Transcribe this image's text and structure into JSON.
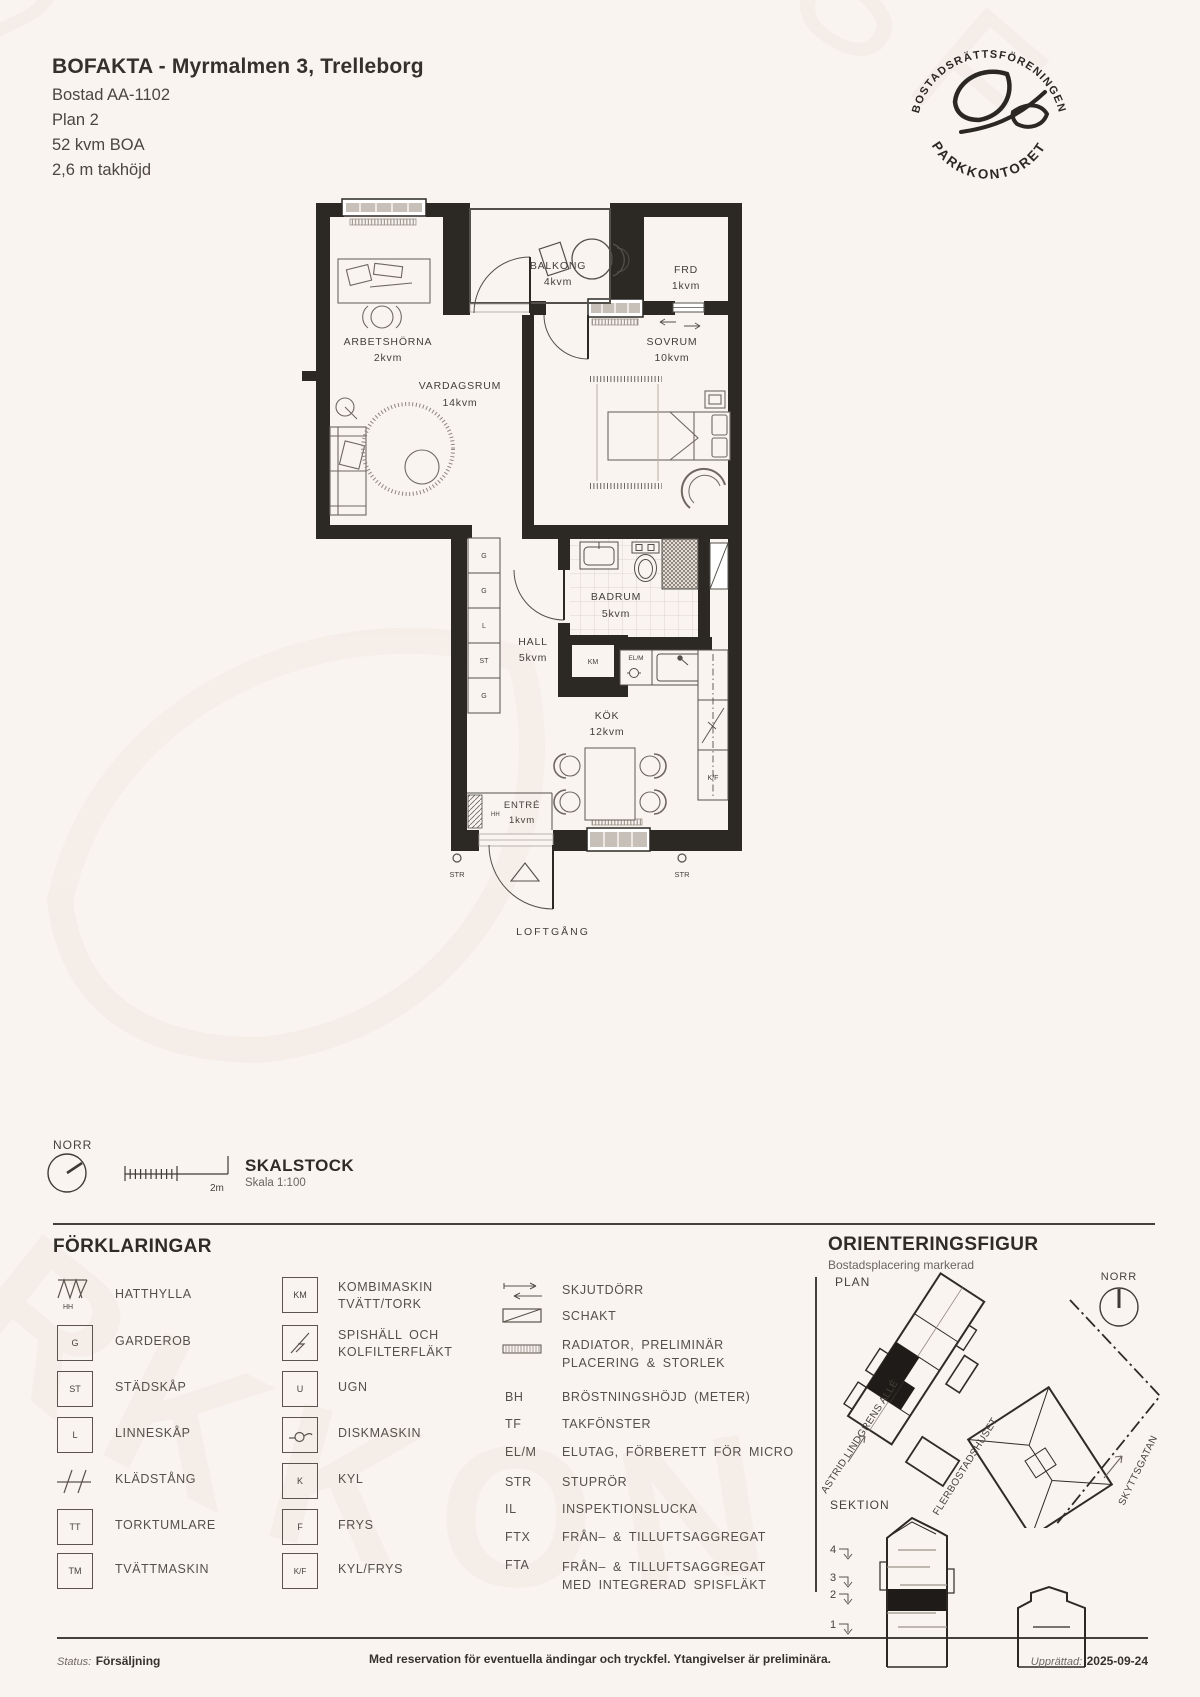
{
  "header": {
    "title": "BOFAKTA - Myrmalmen 3, Trelleborg",
    "lines": [
      "Bostad AA-1102",
      "Plan 2",
      "52 kvm BOA",
      "2,6 m takhöjd"
    ]
  },
  "logo": {
    "top": "BOSTADSRÄTTSFÖRENINGEN",
    "bottom": "• PARKKONTORET •"
  },
  "plan": {
    "rooms": {
      "arbetshorna": {
        "name": "ARBETSHÖRNA",
        "area": "2kvm"
      },
      "balkong": {
        "name": "BALKONG",
        "area": "4kvm"
      },
      "frd": {
        "name": "FRD",
        "area": "1kvm"
      },
      "sovrum": {
        "name": "SOVRUM",
        "area": "10kvm"
      },
      "vardagsrum": {
        "name": "VARDAGSRUM",
        "area": "14kvm"
      },
      "badrum": {
        "name": "BADRUM",
        "area": "5kvm"
      },
      "hall": {
        "name": "HALL",
        "area": "5kvm"
      },
      "kok": {
        "name": "KÖK",
        "area": "12kvm"
      },
      "entre": {
        "name": "ENTRÉ",
        "area": "1kvm"
      }
    },
    "marks": {
      "g": "G",
      "st": "ST",
      "l": "L",
      "km": "KM",
      "elm": "EL/M",
      "kf": "K/F",
      "hh": "HH",
      "str": "STR"
    },
    "loftgang": "LOFTGÅNG"
  },
  "compass": {
    "label": "NORR"
  },
  "scale": {
    "title": "SKALSTOCK",
    "subtitle": "Skala 1:100",
    "bar_label": "2m"
  },
  "legend": {
    "title": "FÖRKLARINGAR",
    "col1": [
      {
        "sym": "HH",
        "label": "HATTHYLLA"
      },
      {
        "sym": "G",
        "label": "GARDEROB"
      },
      {
        "sym": "ST",
        "label": "STÄDSKÅP"
      },
      {
        "sym": "L",
        "label": "LINNESKÅP"
      },
      {
        "sym": "",
        "label": "KLÄDSTÅNG"
      },
      {
        "sym": "TT",
        "label": "TORKTUMLARE"
      },
      {
        "sym": "TM",
        "label": "TVÄTTMASKIN"
      }
    ],
    "col2": [
      {
        "sym": "KM",
        "label": "KOMBIMASKIN",
        "label2": "TVÄTT/TORK"
      },
      {
        "sym": "",
        "label": "SPISHÄLL OCH",
        "label2": "KOLFILTERFLÄKT"
      },
      {
        "sym": "U",
        "label": "UGN"
      },
      {
        "sym": "",
        "label": "DISKMASKIN"
      },
      {
        "sym": "K",
        "label": "KYL"
      },
      {
        "sym": "F",
        "label": "FRYS"
      },
      {
        "sym": "K/F",
        "label": "KYL/FRYS"
      }
    ],
    "col3": [
      {
        "abbr": "",
        "label": "SKJUTDÖRR"
      },
      {
        "abbr": "",
        "label": "SCHAKT"
      },
      {
        "abbr": "",
        "label": "RADIATOR, PRELIMINÄR",
        "label2": "PLACERING & STORLEK"
      },
      {
        "abbr": "BH",
        "label": "BRÖSTNINGSHÖJD (METER)"
      },
      {
        "abbr": "TF",
        "label": "TAKFÖNSTER"
      },
      {
        "abbr": "EL/M",
        "label": "ELUTAG, FÖRBERETT FÖR MICRO"
      },
      {
        "abbr": "STR",
        "label": "STUPRÖR"
      },
      {
        "abbr": "IL",
        "label": "INSPEKTIONSLUCKA"
      },
      {
        "abbr": "FTX",
        "label": "FRÅN– & TILLUFTSAGGREGAT"
      },
      {
        "abbr": "FTA",
        "label": "FRÅN– & TILLUFTSAGGREGAT",
        "label2": "MED INTEGRERAD SPISFLÄKT"
      }
    ]
  },
  "orientation": {
    "title": "ORIENTERINGSFIGUR",
    "subtitle": "Bostadsplacering markerad",
    "plan_label": "PLAN",
    "norr": "NORR",
    "street1": "ASTRID LINDGRENS ALLÉ",
    "building": "FLERBOSTADSHUSET",
    "street2": "SKYTTSGATAN",
    "sektion_label": "SEKTION",
    "floors": [
      "4",
      "3",
      "2",
      "1"
    ]
  },
  "footer": {
    "status_label": "Status:",
    "status_value": "Försäljning",
    "disclaimer": "Med reservation för eventuella ändingar och tryckfel. Ytangivelser är preliminära.",
    "created_label": "Upprättad:",
    "created_value": "2025-09-24"
  }
}
